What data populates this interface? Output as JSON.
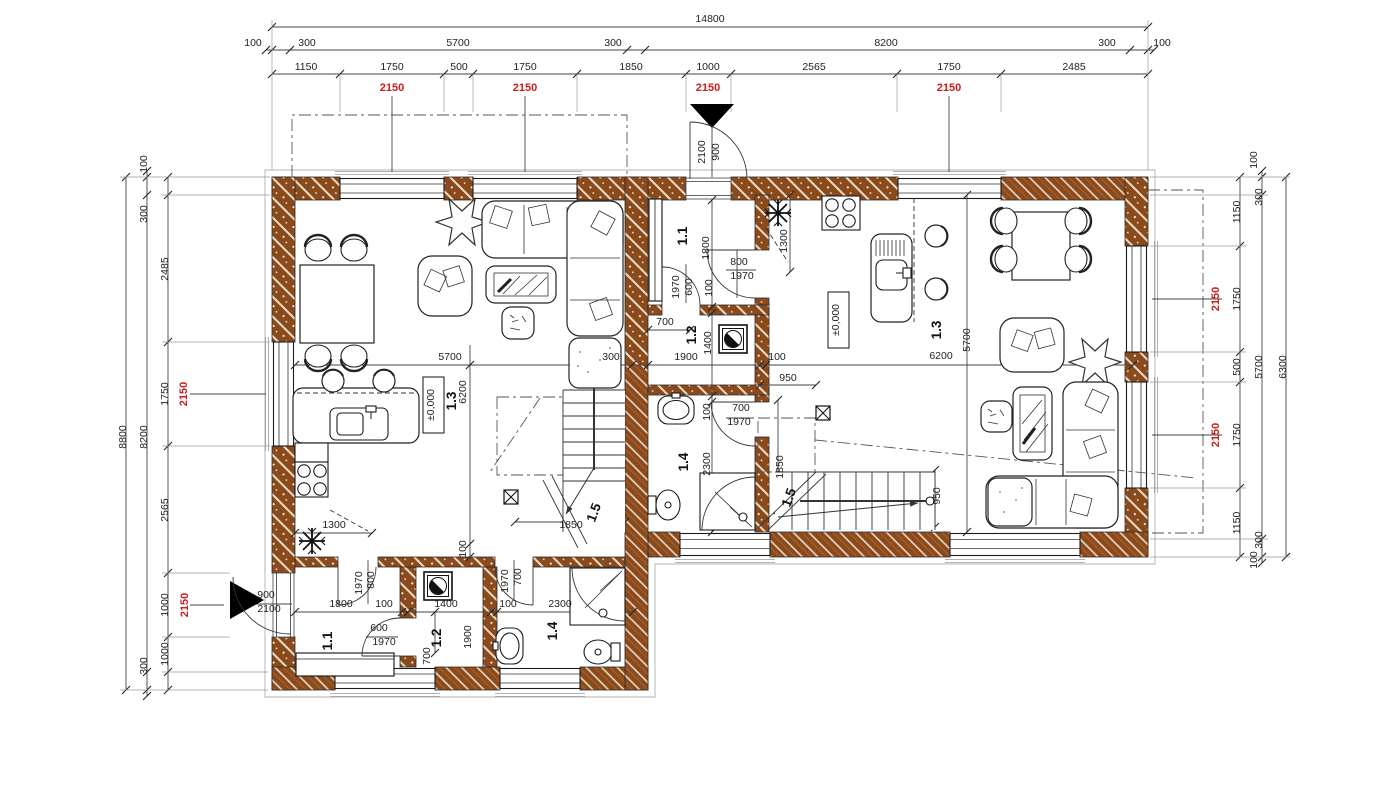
{
  "drawing": {
    "type": "architectural-floor-plan-ground-floor-duplex",
    "level_marker": "±0,000",
    "units": {
      "left_unit_rooms": [
        "1.1",
        "1.2",
        "1.3",
        "1.4",
        "1.5"
      ],
      "right_unit_rooms": [
        "1.1",
        "1.2",
        "1.3",
        "1.4",
        "1.5"
      ]
    },
    "overall": {
      "width": "14800",
      "left_height": "8800",
      "right_height": "6300"
    }
  },
  "colors": {
    "wall_brown": "#8a4a1c",
    "hatch_light": "#ecdcc8",
    "dim_red": "#c81e1e",
    "line_black": "#1c1c1c"
  },
  "labels": [
    {
      "t": "14800",
      "x": 710,
      "y": 22,
      "n": "total-width-label"
    },
    {
      "t": "100",
      "x": 253,
      "y": 46
    },
    {
      "t": "300",
      "x": 307,
      "y": 46
    },
    {
      "t": "5700",
      "x": 458,
      "y": 46
    },
    {
      "t": "300",
      "x": 613,
      "y": 46
    },
    {
      "t": "8200",
      "x": 886,
      "y": 46
    },
    {
      "t": "300",
      "x": 1107,
      "y": 46
    },
    {
      "t": "100",
      "x": 1162,
      "y": 46
    },
    {
      "t": "1150",
      "x": 306,
      "y": 70
    },
    {
      "t": "1750",
      "x": 392,
      "y": 70
    },
    {
      "t": "500",
      "x": 459,
      "y": 70
    },
    {
      "t": "1750",
      "x": 525,
      "y": 70
    },
    {
      "t": "1850",
      "x": 631,
      "y": 70
    },
    {
      "t": "1000",
      "x": 708,
      "y": 70
    },
    {
      "t": "2565",
      "x": 814,
      "y": 70
    },
    {
      "t": "1750",
      "x": 949,
      "y": 70
    },
    {
      "t": "2485",
      "x": 1074,
      "y": 70
    },
    {
      "t": "2150",
      "x": 392,
      "y": 91,
      "k": "red",
      "n": "sill-height-label"
    },
    {
      "t": "2150",
      "x": 525,
      "y": 91,
      "k": "red",
      "n": "sill-height-label"
    },
    {
      "t": "2150",
      "x": 708,
      "y": 91,
      "k": "red",
      "n": "sill-height-label"
    },
    {
      "t": "2150",
      "x": 949,
      "y": 91,
      "k": "red",
      "n": "sill-height-label"
    },
    {
      "t": "900",
      "x": 719,
      "y": 152,
      "r": -90,
      "n": "entry-door-width-label"
    },
    {
      "t": "2100",
      "x": 705,
      "y": 152,
      "r": -90,
      "n": "entry-door-height-label"
    },
    {
      "t": "8800",
      "x": 126,
      "y": 437,
      "r": -90
    },
    {
      "t": "8200",
      "x": 147,
      "y": 437,
      "r": -90
    },
    {
      "t": "100",
      "x": 147,
      "y": 164,
      "r": -90
    },
    {
      "t": "300",
      "x": 147,
      "y": 214,
      "r": -90
    },
    {
      "t": "2485",
      "x": 168,
      "y": 269,
      "r": -90
    },
    {
      "t": "1750",
      "x": 168,
      "y": 394,
      "r": -90
    },
    {
      "t": "2150",
      "x": 187,
      "y": 394,
      "r": -90,
      "k": "red",
      "n": "sill-height-label"
    },
    {
      "t": "2565",
      "x": 168,
      "y": 510,
      "r": -90
    },
    {
      "t": "1000",
      "x": 168,
      "y": 605,
      "r": -90
    },
    {
      "t": "2150",
      "x": 188,
      "y": 605,
      "r": -90,
      "k": "red",
      "n": "sill-height-label"
    },
    {
      "t": "1000",
      "x": 168,
      "y": 654,
      "r": -90
    },
    {
      "t": "300",
      "x": 147,
      "y": 666,
      "r": -90
    },
    {
      "t": "900",
      "x": 266,
      "y": 598,
      "n": "entry-door-width-label"
    },
    {
      "t": "2100",
      "x": 269,
      "y": 612,
      "n": "entry-door-height-label"
    },
    {
      "t": "100",
      "x": 1257,
      "y": 160,
      "r": -90
    },
    {
      "t": "300",
      "x": 1262,
      "y": 197,
      "r": -90
    },
    {
      "t": "1150",
      "x": 1240,
      "y": 212,
      "r": -90
    },
    {
      "t": "1750",
      "x": 1240,
      "y": 299,
      "r": -90
    },
    {
      "t": "2150",
      "x": 1219,
      "y": 299,
      "r": -90,
      "k": "red",
      "n": "sill-height-label"
    },
    {
      "t": "500",
      "x": 1240,
      "y": 367,
      "r": -90
    },
    {
      "t": "5700",
      "x": 1262,
      "y": 367,
      "r": -90
    },
    {
      "t": "6300",
      "x": 1286,
      "y": 367,
      "r": -90
    },
    {
      "t": "1750",
      "x": 1240,
      "y": 435,
      "r": -90
    },
    {
      "t": "2150",
      "x": 1219,
      "y": 435,
      "r": -90,
      "k": "red",
      "n": "sill-height-label"
    },
    {
      "t": "1150",
      "x": 1240,
      "y": 523,
      "r": -90
    },
    {
      "t": "300",
      "x": 1262,
      "y": 540,
      "r": -90
    },
    {
      "t": "100",
      "x": 1257,
      "y": 560,
      "r": -90
    },
    {
      "t": "5700",
      "x": 450,
      "y": 360
    },
    {
      "t": "300",
      "x": 611,
      "y": 360
    },
    {
      "t": "6200",
      "x": 466,
      "y": 392,
      "r": -90
    },
    {
      "t": "100",
      "x": 466,
      "y": 549,
      "r": -90
    },
    {
      "t": "1300",
      "x": 334,
      "y": 528
    },
    {
      "t": "±0,000",
      "x": 434,
      "y": 405,
      "r": -90,
      "n": "level-marker-left"
    },
    {
      "t": "1.3",
      "x": 456,
      "y": 401,
      "r": -90,
      "k": "room",
      "n": "room-label-left-1-3"
    },
    {
      "t": "1850",
      "x": 571,
      "y": 528
    },
    {
      "t": "1.5",
      "x": 598,
      "y": 514,
      "r": -70,
      "k": "room",
      "n": "room-label-left-1-5"
    },
    {
      "t": "1800",
      "x": 341,
      "y": 607
    },
    {
      "t": "100",
      "x": 384,
      "y": 607
    },
    {
      "t": "1400",
      "x": 446,
      "y": 607
    },
    {
      "t": "100",
      "x": 508,
      "y": 607
    },
    {
      "t": "2300",
      "x": 560,
      "y": 607
    },
    {
      "t": "1.1",
      "x": 332,
      "y": 641,
      "r": -90,
      "k": "room",
      "n": "room-label-left-1-1"
    },
    {
      "t": "800",
      "x": 374,
      "y": 580,
      "r": -90
    },
    {
      "t": "1970",
      "x": 362,
      "y": 583,
      "r": -90
    },
    {
      "t": "600",
      "x": 379,
      "y": 631
    },
    {
      "t": "1970",
      "x": 384,
      "y": 645
    },
    {
      "t": "1.2",
      "x": 441,
      "y": 638,
      "r": -90,
      "k": "room",
      "n": "room-label-left-1-2"
    },
    {
      "t": "1900",
      "x": 471,
      "y": 637,
      "r": -90
    },
    {
      "t": "700",
      "x": 430,
      "y": 656,
      "r": -90
    },
    {
      "t": "700",
      "x": 521,
      "y": 577,
      "r": -90
    },
    {
      "t": "1970",
      "x": 508,
      "y": 581,
      "r": -90
    },
    {
      "t": "1.4",
      "x": 557,
      "y": 631,
      "r": -90,
      "k": "room",
      "n": "room-label-left-1-4"
    },
    {
      "t": "1.1",
      "x": 687,
      "y": 236,
      "r": -90,
      "k": "room",
      "n": "room-label-right-1-1"
    },
    {
      "t": "1800",
      "x": 709,
      "y": 248,
      "r": -90
    },
    {
      "t": "800",
      "x": 739,
      "y": 265
    },
    {
      "t": "1970",
      "x": 742,
      "y": 279
    },
    {
      "t": "1970",
      "x": 679,
      "y": 287,
      "r": -90
    },
    {
      "t": "600",
      "x": 692,
      "y": 287,
      "r": -90
    },
    {
      "t": "100",
      "x": 712,
      "y": 288,
      "r": -90
    },
    {
      "t": "1300",
      "x": 787,
      "y": 241,
      "r": -90
    },
    {
      "t": "700",
      "x": 665,
      "y": 325
    },
    {
      "t": "1.2",
      "x": 696,
      "y": 335,
      "r": -90,
      "k": "room",
      "n": "room-label-right-1-2"
    },
    {
      "t": "1400",
      "x": 711,
      "y": 343,
      "r": -90
    },
    {
      "t": "1900",
      "x": 686,
      "y": 360
    },
    {
      "t": "100",
      "x": 777,
      "y": 360
    },
    {
      "t": "6200",
      "x": 941,
      "y": 359
    },
    {
      "t": "5700",
      "x": 970,
      "y": 340,
      "r": -90
    },
    {
      "t": "1.3",
      "x": 941,
      "y": 330,
      "r": -90,
      "k": "room",
      "n": "room-label-right-1-3"
    },
    {
      "t": "±0,000",
      "x": 839,
      "y": 320,
      "r": -90,
      "n": "level-marker-right"
    },
    {
      "t": "950",
      "x": 788,
      "y": 381
    },
    {
      "t": "100",
      "x": 710,
      "y": 412,
      "r": -90
    },
    {
      "t": "700",
      "x": 741,
      "y": 411
    },
    {
      "t": "1970",
      "x": 739,
      "y": 425
    },
    {
      "t": "2300",
      "x": 710,
      "y": 464,
      "r": -90
    },
    {
      "t": "1.4",
      "x": 688,
      "y": 462,
      "r": -90,
      "k": "room",
      "n": "room-label-right-1-4"
    },
    {
      "t": "1850",
      "x": 783,
      "y": 467,
      "r": -90
    },
    {
      "t": "1.5",
      "x": 793,
      "y": 499,
      "r": -70,
      "k": "room",
      "n": "room-label-right-1-5"
    },
    {
      "t": "950",
      "x": 940,
      "y": 496,
      "r": -90
    }
  ]
}
